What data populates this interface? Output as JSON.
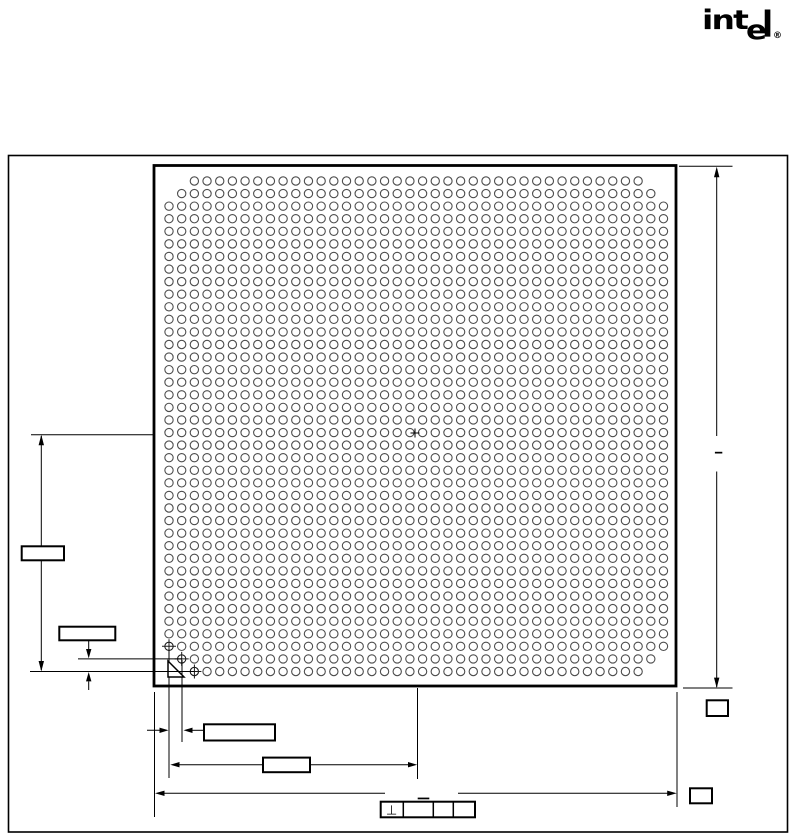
{
  "logo": {
    "int": "int",
    "e": "e",
    "l": "l",
    "registered": "®"
  },
  "drawing": {
    "title": "BGA package bottom-view mechanical drawing",
    "background": "#ffffff",
    "line_color": "#000000",
    "ball_outline_color": "#4d4d4d",
    "ball_grid": {
      "rows": 40,
      "cols": 40,
      "total_balls": 1588,
      "missing_balls": [
        [
          1,
          1
        ],
        [
          1,
          2
        ],
        [
          2,
          1
        ],
        [
          1,
          39
        ],
        [
          1,
          40
        ],
        [
          2,
          40
        ],
        [
          39,
          1
        ],
        [
          40,
          1
        ],
        [
          40,
          2
        ],
        [
          39,
          40
        ],
        [
          40,
          39
        ],
        [
          40,
          40
        ]
      ],
      "crosshair_marked_balls": [
        [
          38,
          1
        ],
        [
          39,
          2
        ],
        [
          40,
          3
        ]
      ]
    },
    "gdt": {
      "perpendicularity": "⊥"
    },
    "callouts": [
      {
        "id": "left-center-to-ball-row",
        "label": ""
      },
      {
        "id": "left-ball-row-offset",
        "label": ""
      },
      {
        "id": "bottom-ball-pitch",
        "label": ""
      },
      {
        "id": "bottom-edge-to-center",
        "label": ""
      },
      {
        "id": "bottom-overall-width",
        "label": ""
      },
      {
        "id": "right-overall-height",
        "label": ""
      },
      {
        "id": "right-corner-ref",
        "label": ""
      }
    ]
  }
}
